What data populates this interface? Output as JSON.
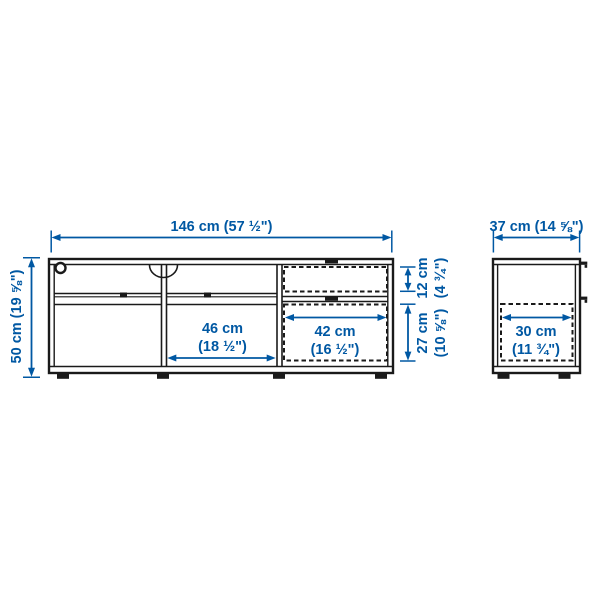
{
  "product_diagram": {
    "front_view": {
      "width": "146 cm (57 ½\")",
      "height": "50 cm (19 ⅝\")",
      "shelf_inner_width": {
        "cm": "46 cm",
        "inches": "(18 ½\")"
      },
      "drawer_inner_width": {
        "cm": "42 cm",
        "inches": "(16 ½\")"
      },
      "top_drawer_height": {
        "cm": "12 cm",
        "inches": "(4 ¾\")"
      },
      "bottom_drawer_height": {
        "cm": "27 cm",
        "inches": "(10 ⅝\")"
      }
    },
    "side_view": {
      "depth": "37 cm (14 ⅝\")",
      "inner_depth": {
        "cm": "30 cm",
        "inches": "(11 ¾\")"
      }
    },
    "colors": {
      "dimension_blue": "#0058a3",
      "outline_black": "#1a1a1a",
      "background": "#ffffff"
    }
  }
}
